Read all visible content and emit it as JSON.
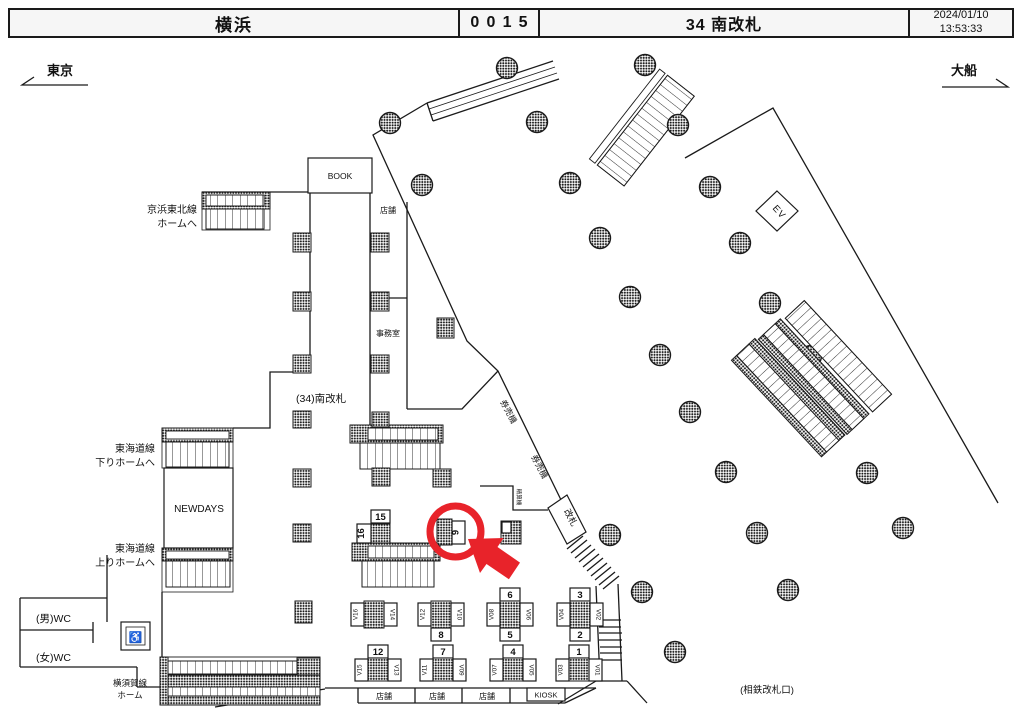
{
  "header": {
    "station": "横浜",
    "code": "0015",
    "title": "34 南改札",
    "date": "2024/01/10",
    "time": "13:53:33"
  },
  "directions": {
    "left": "東京",
    "right": "大船"
  },
  "labels": {
    "keihin_line1": "京浜東北線",
    "keihin_line2": "ホームへ",
    "book": "BOOK",
    "shop_small": "店舗",
    "office": "事務室",
    "minami_gate": "(34)南改札",
    "ticket_machines": "券売機",
    "fare_adjustment": "精算機",
    "kaisatsu": "改札",
    "ev": "EV",
    "tokaido_down_line1": "東海道線",
    "tokaido_down_line2": "下りホームへ",
    "newdays": "NEWDAYS",
    "tokaido_up_line1": "東海道線",
    "tokaido_up_line2": "上りホームへ",
    "wc_men": "(男)WC",
    "wc_women": "(女)WC",
    "yokosuka_line1": "横須賀線",
    "yokosuka_line2": "ホーム",
    "shop1": "店舗",
    "shop2": "店舗",
    "shop3": "店舗",
    "kiosk": "KIOSK",
    "sotetsu": "(相鉄改札口)"
  },
  "icons": {
    "wheelchair": "♿"
  },
  "highlight": {
    "number": "9"
  },
  "pillar15": {
    "top": "15",
    "side": "16"
  },
  "top_row": [
    {
      "v_left": "V16",
      "v_right": "V14"
    },
    {
      "v_left": "V12",
      "v_right": "V10",
      "num_bottom": "8"
    },
    {
      "num_top": "6",
      "v_left": "V08",
      "v_right": "V06",
      "num_bottom": "5"
    },
    {
      "num_top": "3",
      "v_left": "V04",
      "v_right": "V02",
      "num_bottom": "2"
    }
  ],
  "bottom_row": [
    {
      "num_top": "12",
      "v_left": "V15",
      "v_right": "V13"
    },
    {
      "num_top": "7",
      "v_left": "V11",
      "v_right": "V09"
    },
    {
      "num_top": "4",
      "v_left": "V07",
      "v_right": "V05"
    },
    {
      "num_top": "1",
      "v_left": "V03",
      "v_right": "V01"
    }
  ],
  "colors": {
    "red": "#e8232a",
    "ink": "#1a1a1a"
  }
}
